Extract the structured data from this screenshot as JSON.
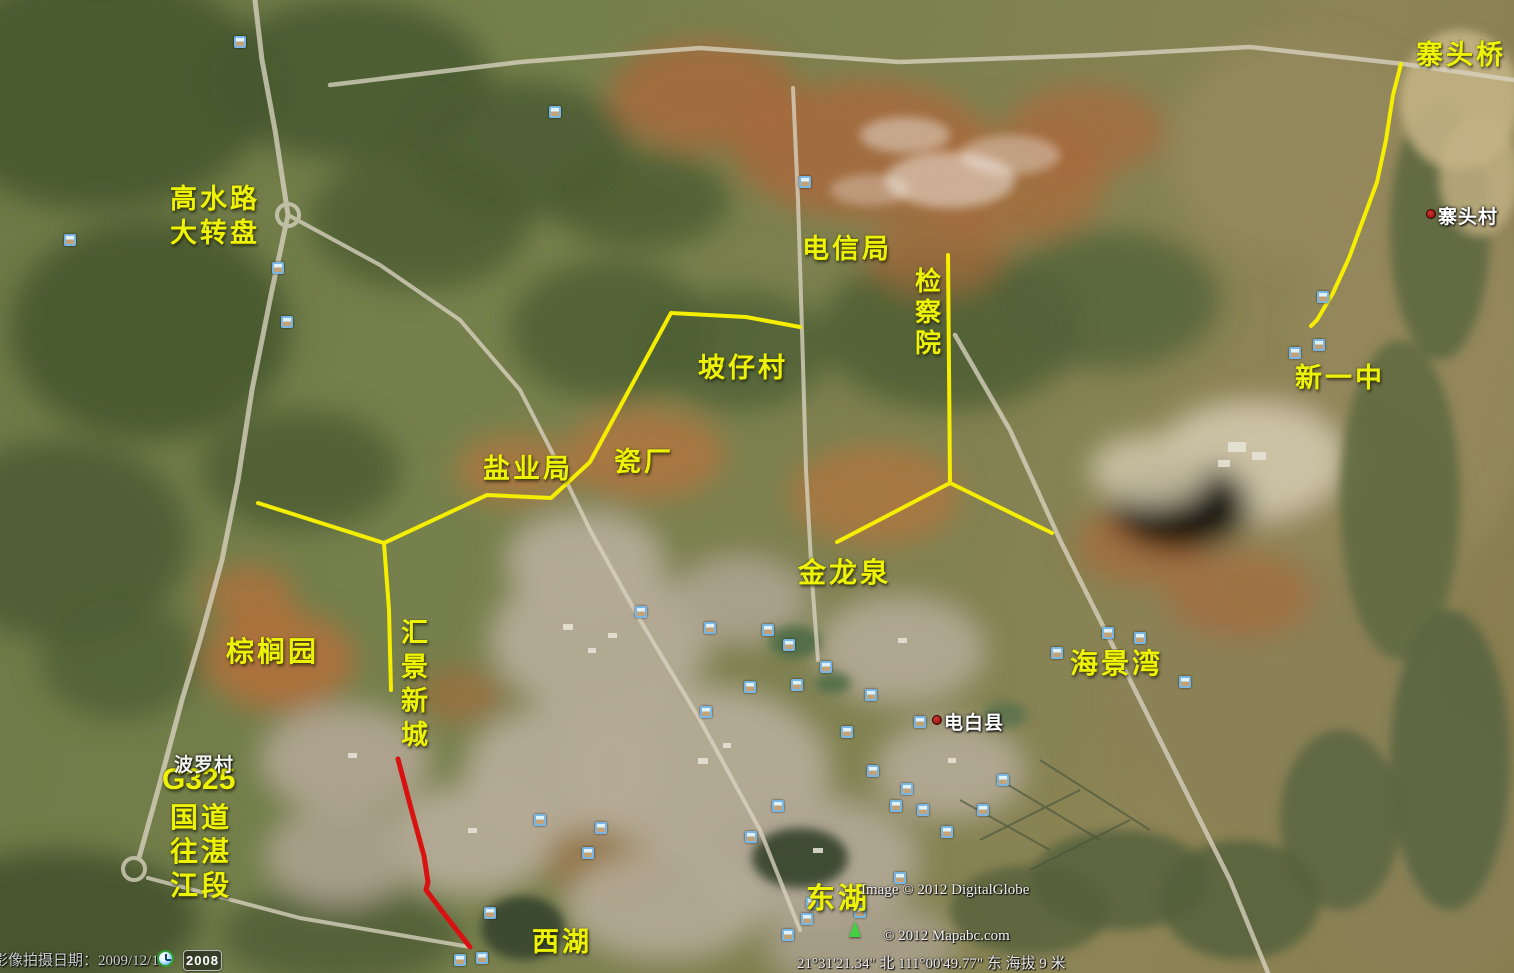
{
  "annotations": {
    "zhaitouqiao": "寨头桥",
    "gaoshuilu": "高水路",
    "dazhuanpan": "大转盘",
    "dianxinju": "电信局",
    "jianchayuan": "检察院",
    "pozicun": "坡仔村",
    "xinyizhong": "新一中",
    "yanyeju": "盐业局",
    "cichang": "瓷厂",
    "jinlongquan": "金龙泉",
    "haijingwan": "海景湾",
    "zonglvyuan": "棕榈园",
    "huijingxincheng": "汇景新城",
    "g325": "G325",
    "guodao": "国道",
    "wangzhan": "往湛",
    "jiangduan": "江段",
    "donghu": "东湖",
    "xihu": "西湖"
  },
  "place_labels": {
    "zhaitoucun": "寨头村",
    "dianbaixian": "电白县",
    "boluocun": "波罗村"
  },
  "status_bar": {
    "imagery_date": "影像拍摄日期：2009/12/11",
    "timeline_year": "2008",
    "copyright_digitalglobe": "Image © 2012 DigitalGlobe",
    "copyright_mapabc": "© 2012 Mapabc.com",
    "coordinates": "21°31'21.34\" 北  111°00'49.77\" 东  海拔    9 米"
  },
  "icons": {
    "photo": "photo-thumbnail-icon",
    "clock": "historical-imagery-clock-icon",
    "marker": "place-marker-dot",
    "arrow": "green-arrow-icon"
  },
  "route_colors": {
    "drawn_yellow": "#f5ee00",
    "drawn_red": "#d81111"
  },
  "routes": [
    {
      "name": "route-zhaitou-bridge",
      "color": "#f5ee00",
      "width": 4,
      "points": [
        [
          1401,
          64
        ],
        [
          1393,
          95
        ],
        [
          1386,
          140
        ],
        [
          1377,
          182
        ],
        [
          1363,
          220
        ],
        [
          1349,
          258
        ],
        [
          1333,
          293
        ],
        [
          1317,
          320
        ],
        [
          1311,
          326
        ]
      ]
    },
    {
      "name": "route-west-main",
      "color": "#f5ee00",
      "width": 4,
      "points": [
        [
          800,
          327
        ],
        [
          746,
          317
        ],
        [
          671,
          313
        ],
        [
          590,
          462
        ],
        [
          551,
          498
        ],
        [
          487,
          495
        ],
        [
          384,
          543
        ],
        [
          258,
          503
        ]
      ]
    },
    {
      "name": "route-huijing-spur",
      "color": "#f5ee00",
      "width": 4,
      "points": [
        [
          384,
          543
        ],
        [
          389,
          610
        ],
        [
          391,
          690
        ]
      ]
    },
    {
      "name": "route-jianchayuan",
      "color": "#f5ee00",
      "width": 4,
      "points": [
        [
          837,
          542
        ],
        [
          950,
          483
        ],
        [
          948,
          255
        ]
      ]
    },
    {
      "name": "route-jinlong-east",
      "color": "#f5ee00",
      "width": 4,
      "points": [
        [
          950,
          483
        ],
        [
          1052,
          533
        ]
      ]
    },
    {
      "name": "route-red-section",
      "color": "#d81111",
      "width": 5,
      "points": [
        [
          398,
          759
        ],
        [
          412,
          812
        ],
        [
          424,
          856
        ],
        [
          428,
          882
        ],
        [
          426,
          890
        ],
        [
          445,
          915
        ],
        [
          470,
          947
        ]
      ]
    }
  ],
  "photo_icons": [
    [
      555,
      112
    ],
    [
      805,
      182
    ],
    [
      240,
      42
    ],
    [
      70,
      240
    ],
    [
      278,
      268
    ],
    [
      287,
      322
    ],
    [
      1319,
      345
    ],
    [
      1295,
      353
    ],
    [
      1323,
      297
    ],
    [
      1108,
      633
    ],
    [
      1140,
      638
    ],
    [
      1057,
      653
    ],
    [
      1185,
      682
    ],
    [
      710,
      628
    ],
    [
      768,
      630
    ],
    [
      789,
      645
    ],
    [
      826,
      667
    ],
    [
      750,
      687
    ],
    [
      797,
      685
    ],
    [
      871,
      695
    ],
    [
      706,
      712
    ],
    [
      920,
      722
    ],
    [
      847,
      732
    ],
    [
      873,
      771
    ],
    [
      907,
      789
    ],
    [
      896,
      806
    ],
    [
      923,
      810
    ],
    [
      947,
      832
    ],
    [
      983,
      810
    ],
    [
      1003,
      780
    ],
    [
      778,
      806
    ],
    [
      751,
      837
    ],
    [
      601,
      828
    ],
    [
      588,
      853
    ],
    [
      641,
      612
    ],
    [
      900,
      878
    ],
    [
      812,
      903
    ],
    [
      807,
      919
    ],
    [
      788,
      935
    ],
    [
      860,
      912
    ],
    [
      540,
      820
    ],
    [
      490,
      913
    ],
    [
      460,
      960
    ],
    [
      482,
      958
    ]
  ]
}
